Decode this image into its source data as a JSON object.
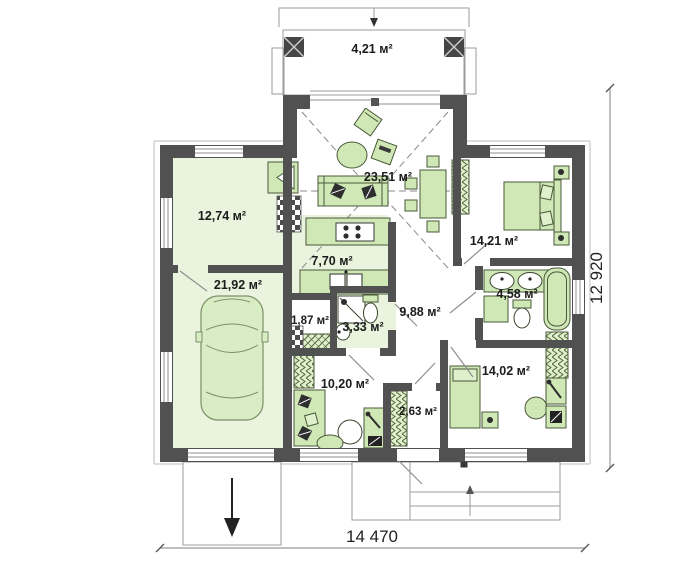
{
  "floor_plan": {
    "rooms": [
      {
        "id": "terrace",
        "area_label": "4,21 м²"
      },
      {
        "id": "living-room",
        "area_label": "23,51 м²"
      },
      {
        "id": "utility-room",
        "area_label": "12,74 м²"
      },
      {
        "id": "garage",
        "area_label": "21,92 м²"
      },
      {
        "id": "bedroom-1",
        "area_label": "14,21 м²"
      },
      {
        "id": "kitchen",
        "area_label": "7,70 м²"
      },
      {
        "id": "bathroom-1",
        "area_label": "4,58 м²"
      },
      {
        "id": "hallway",
        "area_label": "9,88 м²"
      },
      {
        "id": "pantry",
        "area_label": "1,87 м²"
      },
      {
        "id": "bathroom-2",
        "area_label": "3,33 м²"
      },
      {
        "id": "bedroom-2",
        "area_label": "14,02 м²"
      },
      {
        "id": "bedroom-3",
        "area_label": "10,20 м²"
      },
      {
        "id": "vestibule",
        "area_label": "2,63 м²"
      }
    ],
    "dimensions": {
      "overall_width": "14 470",
      "overall_height": "12 920"
    },
    "colors": {
      "wall": "#515151",
      "room_tint": "#e9f3dd",
      "furniture": "#cfe8b6",
      "outline": "#9b9b9b"
    }
  }
}
